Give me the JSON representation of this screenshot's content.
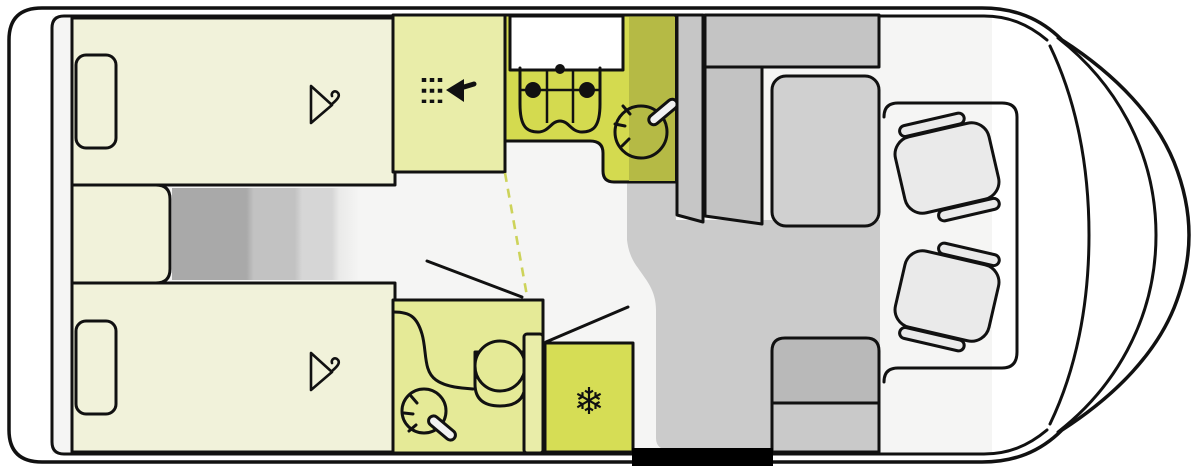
{
  "diagram": {
    "kind": "motorhome-floorplan-top-view"
  },
  "colors": {
    "outline": "#111111",
    "body": "#f8f8f8",
    "floor": "#f5f5f4",
    "floor_shade": "#cbcbcb",
    "bed": "#f1f2da",
    "shower": "#e9eda9",
    "kitchen": "#d4da4f",
    "kitchen_shade": "#b5ba45",
    "bathroom": "#e5ea97",
    "bathroom_door": "#e9eda9",
    "fridge": "#d6dd55",
    "door_dash": "#cdd35a",
    "worktop": "#ffffff",
    "cabinet_gray": "#c6c6c6",
    "bench_wall_gray": "#c4c4c4",
    "bench_side_gray": "#c3c3c3",
    "table_gray": "#d0d0d0",
    "entry_bench_dark": "#b9b9b9",
    "entry_bench_light": "#c9c9c9",
    "seat": "#eaeaea",
    "hanger": "#c6c6bb",
    "threshold": "#000000",
    "wand_fill": "#f2f2f2"
  },
  "icons": {
    "snowflake_glyph": "❄",
    "hanger": "clothes-hanger-icon",
    "shower": "shower-spray-icon",
    "hob": "stove-burners-icon",
    "sink": "faucet-basin-icon",
    "toilet": "toilet-icon",
    "snowflake": "snowflake-fridge-icon"
  }
}
